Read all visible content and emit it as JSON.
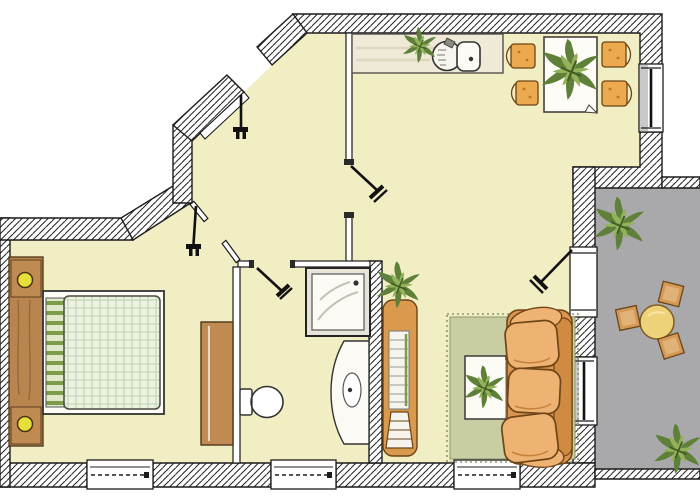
{
  "canvas": {
    "width": 700,
    "height": 500
  },
  "drawing_type": "apartment-floor-plan",
  "palette": {
    "floor": "#f1eec3",
    "hatch_line": "#222222",
    "wall_outline": "#1c1c1c",
    "balcony_floor": "#a9a9ab",
    "rug": "#c8cda2",
    "rug_border": "#8d9670",
    "sofa_base": "#d89450",
    "sofa_cushion": "#eeb273",
    "sofa_dark": "#6f4517",
    "sofa_shade": "#c5823c",
    "chair": "#eca94e",
    "wood": "#b9854f",
    "wood_dark": "#4a3418",
    "wood_light": "#c08b52",
    "lamp_yellow": "#e6df39",
    "duvet_base": "#eef2e1",
    "duvet_line": "#c9dabd",
    "stripe_green": "#7d9c4a",
    "plant_dark": "#5f8038",
    "plant_light": "#93b25a",
    "stool": "#d39a57",
    "balcony_table": "#edd279",
    "kitchen_counter": "#efe9d7",
    "fixture_white": "#fbfaf4",
    "window_shade": "#c9c9c9"
  },
  "rooms": [
    {
      "id": "bedroom",
      "items": [
        "headboard-with-lamps",
        "double-bed",
        "wardrobe",
        "window"
      ]
    },
    {
      "id": "bathroom",
      "items": [
        "shower",
        "toilet",
        "washbasin-vanity",
        "window",
        "door"
      ]
    },
    {
      "id": "hall",
      "items": [
        "entry-door",
        "bedroom-door",
        "living-room-door"
      ]
    },
    {
      "id": "kitchen-dining",
      "items": [
        "kitchen-counter-with-sink",
        "counter-plant",
        "dining-table",
        "table-plant",
        "chair",
        "chair",
        "chair",
        "chair",
        "french-window"
      ]
    },
    {
      "id": "living-room",
      "items": [
        "rug",
        "sofa",
        "coffee-table",
        "table-plant",
        "loft-stairs",
        "stairs-plant",
        "balcony-door",
        "window",
        "bottom-window"
      ]
    },
    {
      "id": "balcony",
      "items": [
        "round-table",
        "stool",
        "stool",
        "stool",
        "plant",
        "plant",
        "parapet"
      ]
    }
  ]
}
